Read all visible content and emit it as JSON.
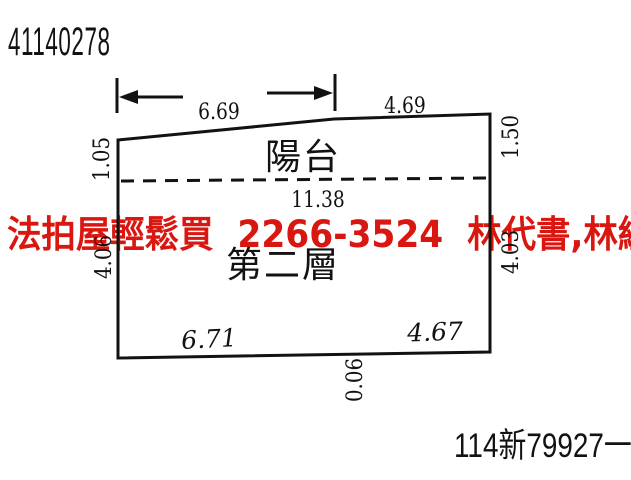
{
  "page": {
    "background": "#ffffff",
    "ink_color": "#121212"
  },
  "header": {
    "drawing_number": "41140278"
  },
  "plan": {
    "balcony_label": "陽台",
    "floor_label": "第二層",
    "dimensions": {
      "top_width_left": "6.69",
      "top_width_right": "4.69",
      "balcony_depth_left": "1.05",
      "balcony_depth_right": "1.50",
      "interior_width": "11.38",
      "side_depth_left": "4.06",
      "side_depth_right": "4.03",
      "bottom_width_left": "6.71",
      "bottom_width_right": "4.67",
      "bottom_offset": "0.06"
    }
  },
  "watermark": {
    "text": "法拍屋輕鬆買  2266-3524  林代書,林經理",
    "color": "#d9160f"
  },
  "footer": {
    "case_number": "114新79927一"
  }
}
